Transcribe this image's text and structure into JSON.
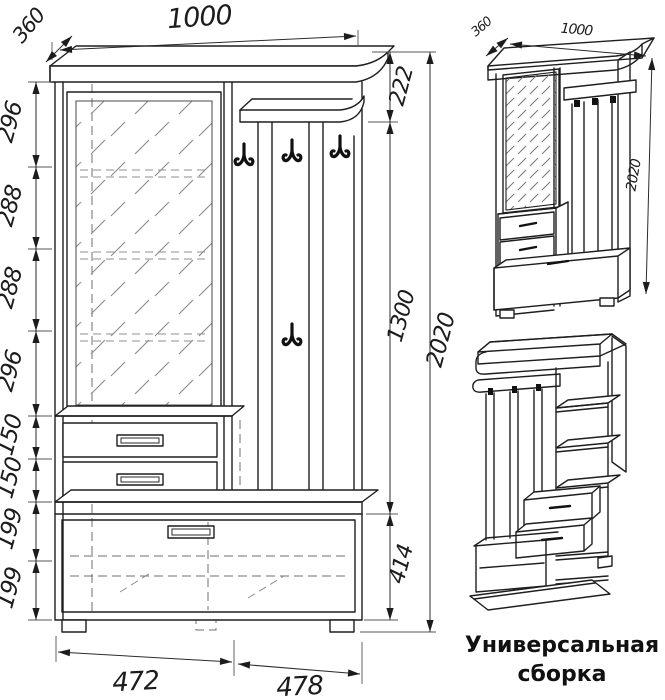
{
  "drawing": {
    "front_view": {
      "width_top": "1000",
      "depth": "360",
      "left_heights": [
        "296",
        "288",
        "288",
        "296",
        "150",
        "150",
        "199",
        "199"
      ],
      "right_heights": [
        "222",
        "1300",
        "414"
      ],
      "total_height": "2020",
      "bottom_widths": [
        "472",
        "478"
      ]
    },
    "iso_view": {
      "depth": "360",
      "width": "1000",
      "height": "2020"
    },
    "caption_line1": "Универсальная",
    "caption_line2": "сборка",
    "colors": {
      "line": "#1e1e1e",
      "hatch": "#8f8f8f",
      "background": "#ffffff"
    }
  }
}
